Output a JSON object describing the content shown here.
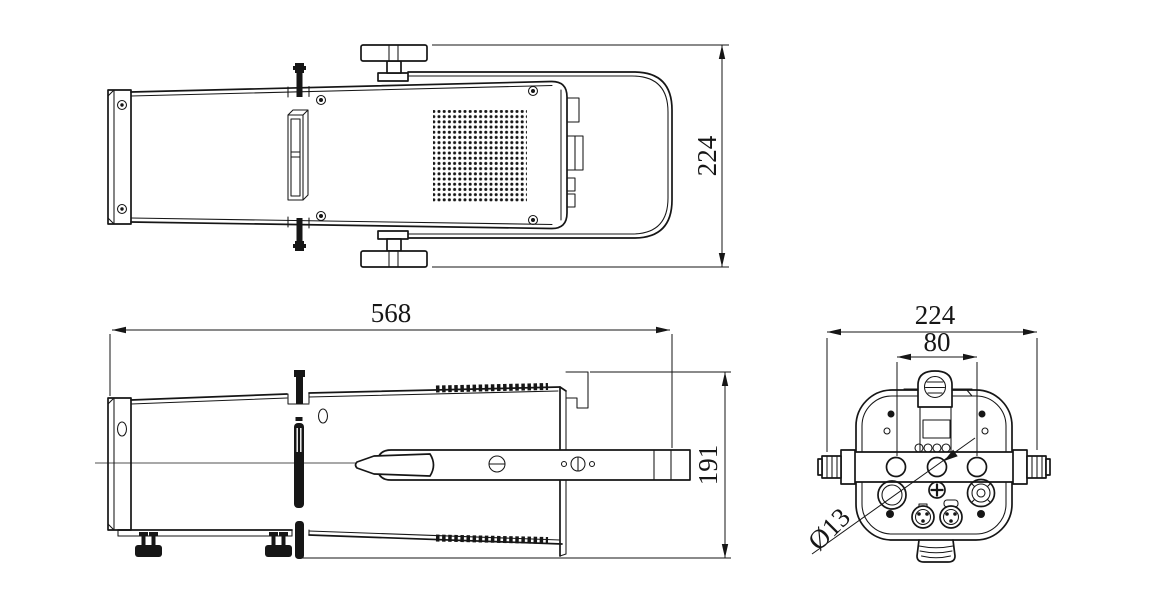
{
  "drawing": {
    "title": "stage-light-fixture-three-view-drawing",
    "background_color": "#ffffff",
    "line_color": "#161616",
    "dimensions": {
      "overall_width": "224",
      "overall_length": "568",
      "overall_height": "191",
      "rear_width": "224",
      "mount_hole_spacing": "80",
      "mount_hole_diameter": "Ø13"
    }
  }
}
